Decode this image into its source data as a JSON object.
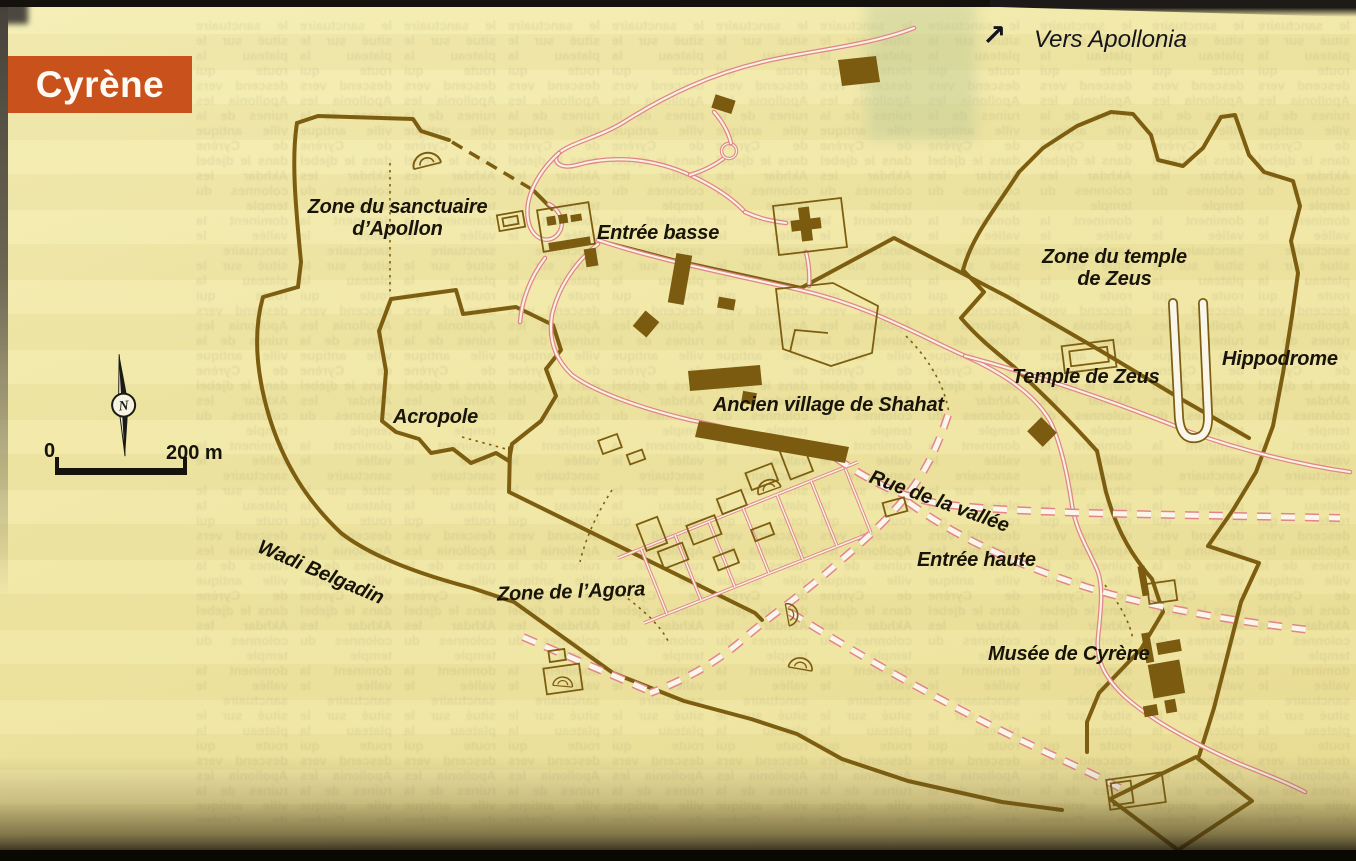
{
  "page": {
    "banner": "Cyrène"
  },
  "map": {
    "labels": {
      "vers_apollonia": "Vers Apollonia",
      "arrow_ne": "↗",
      "sanctuaire_line1": "Zone du sanctuaire",
      "sanctuaire_line2": "d’Apollon",
      "entree_basse": "Entrée basse",
      "zone_temple_line1": "Zone du temple",
      "zone_temple_line2": "de Zeus",
      "temple_zeus": "Temple de Zeus",
      "hippodrome": "Hippodrome",
      "ancien_village": "Ancien village de Shahat",
      "acropole": "Acropole",
      "rue_vallee": "Rue de la vallée",
      "entree_haute": "Entrée haute",
      "zone_agora": "Zone de l’Agora",
      "wadi_belgadin": "Wadi Belgadin",
      "musee": "Musée de Cyrène"
    },
    "compass": {
      "north": "N"
    },
    "scale": {
      "start": "0",
      "end": "200 m"
    },
    "colors": {
      "paper": "#f1e8a6",
      "wall_brown": "#7d5e10",
      "road_pink": "#e2848a",
      "road_fill": "#f8f4e0",
      "banner_orange": "#c8511c",
      "label_black": "#191408"
    }
  },
  "showthrough": {
    "sample": "le sanctuaire situé sur le plateau la route qui descend vers Apollonia les ruines de la ville antique de Cyrène dans le djebel Akhdar les colonnes du temple dominent la vallée"
  }
}
